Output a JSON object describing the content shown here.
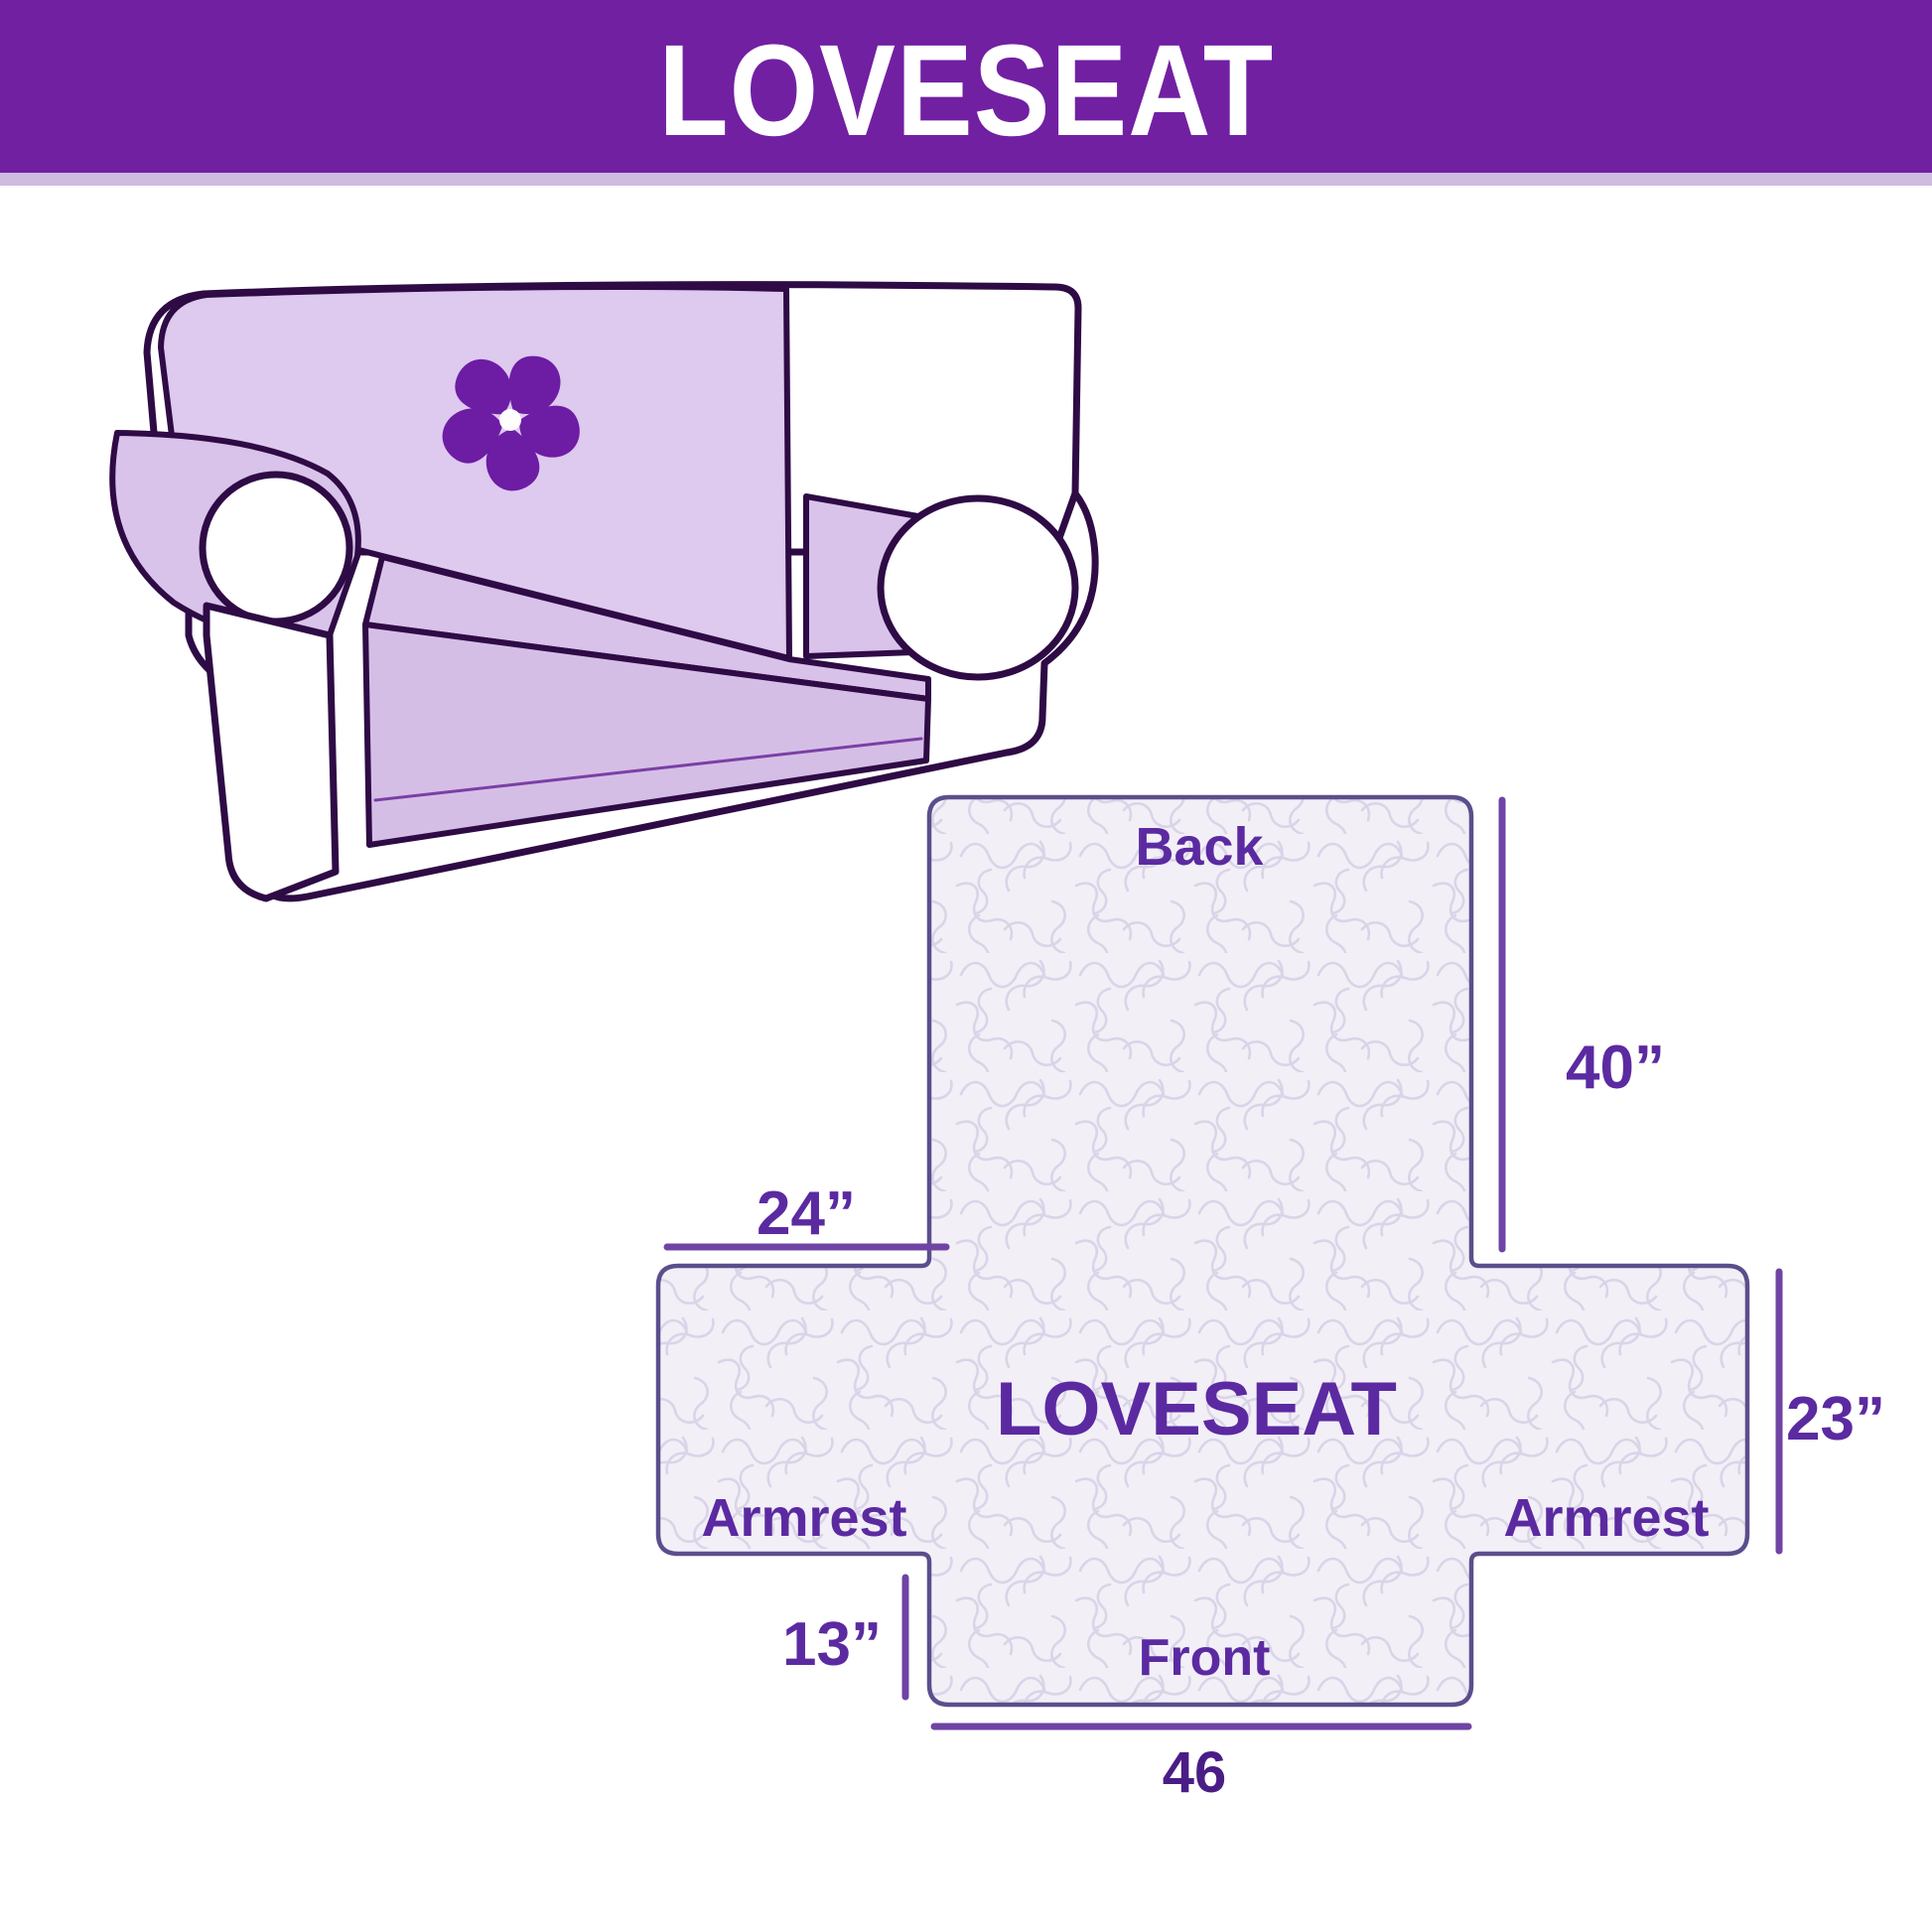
{
  "header": {
    "title": "LOVESEAT"
  },
  "illustration": {
    "description": "Hand-drawn loveseat sofa wearing a lavender slipcover with pinwheel logo",
    "logo_icon": "pinwheel"
  },
  "diagram": {
    "product_label": "LOVESEAT",
    "back_label": "Back",
    "front_label": "Front",
    "armrest_left_label": "Armrest",
    "armrest_right_label": "Armrest",
    "dim_back_height": "40”",
    "dim_armrest_top_width": "24”",
    "dim_side_height": "23”",
    "dim_front_drop": "13”",
    "dim_front_width": "46"
  },
  "colors": {
    "header_bg": "#7120A2",
    "header_strip": "#CDBBE0",
    "header_text": "#FFFFFF",
    "label_text": "#5B2AA1",
    "dimension_line": "#6F44A4",
    "shape_outline": "#5C4E8C",
    "fabric_base": "#F2EFF7",
    "fabric_pattern": "#DAD4E8",
    "sofa_outline": "#2E0B45",
    "cover_fill": "#DCC6EC",
    "logo_purple": "#6D1CA4"
  }
}
